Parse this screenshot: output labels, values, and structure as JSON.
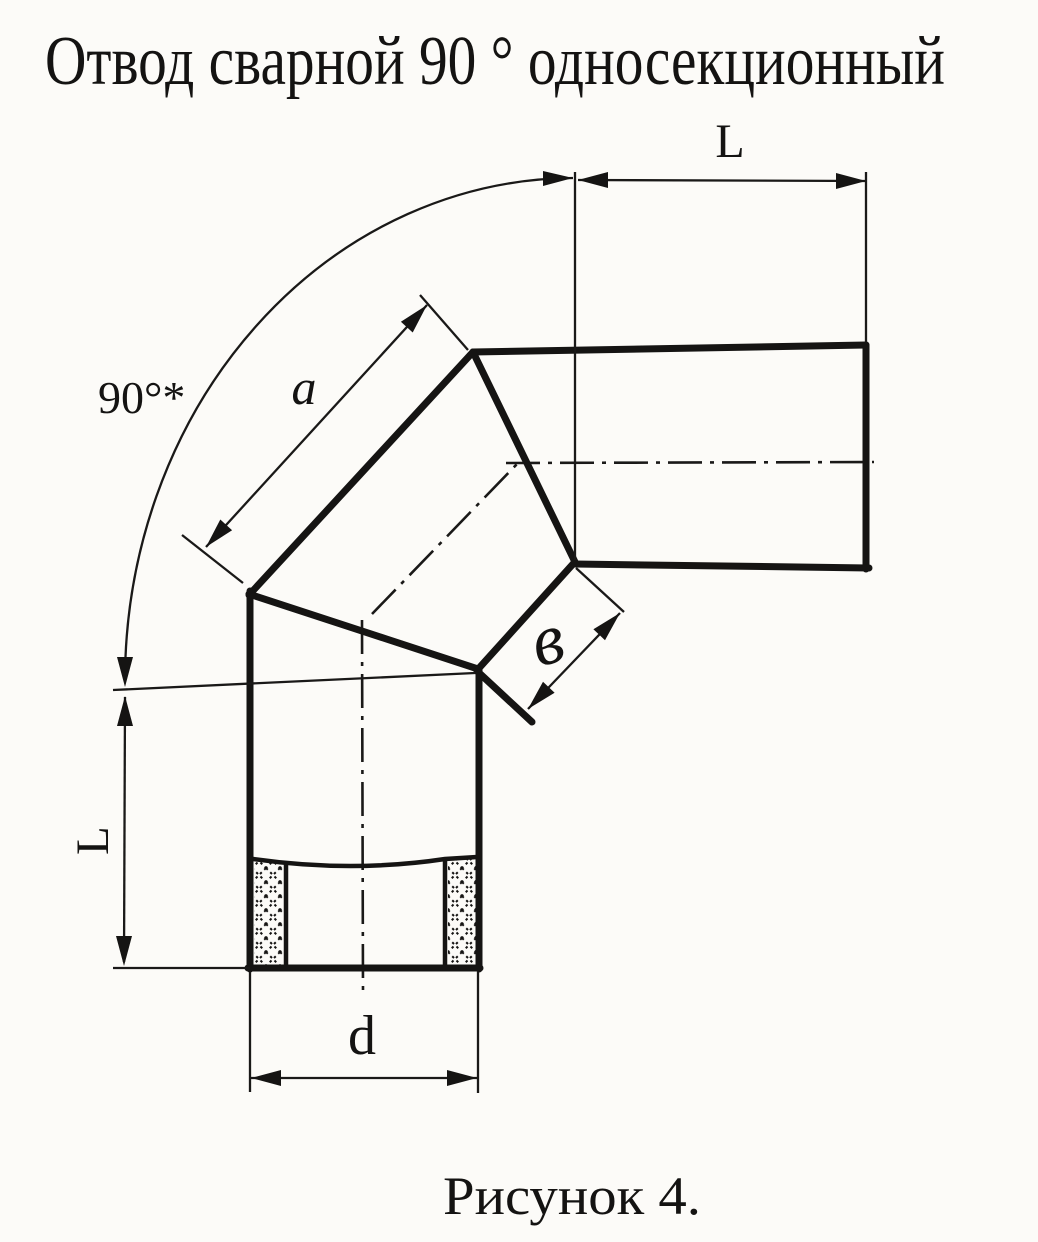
{
  "title": "Отвод сварной 90 ° односекционный",
  "caption": "Рисунок 4.",
  "dimensions": {
    "top_run_length": "L",
    "left_run_length": "L",
    "bend_angle": "90°*",
    "segment_outer_length": "a",
    "segment_end_width": "в",
    "pipe_diameter": "d"
  },
  "colors": {
    "ink": "#151413",
    "paper": "#fcfbf8"
  }
}
